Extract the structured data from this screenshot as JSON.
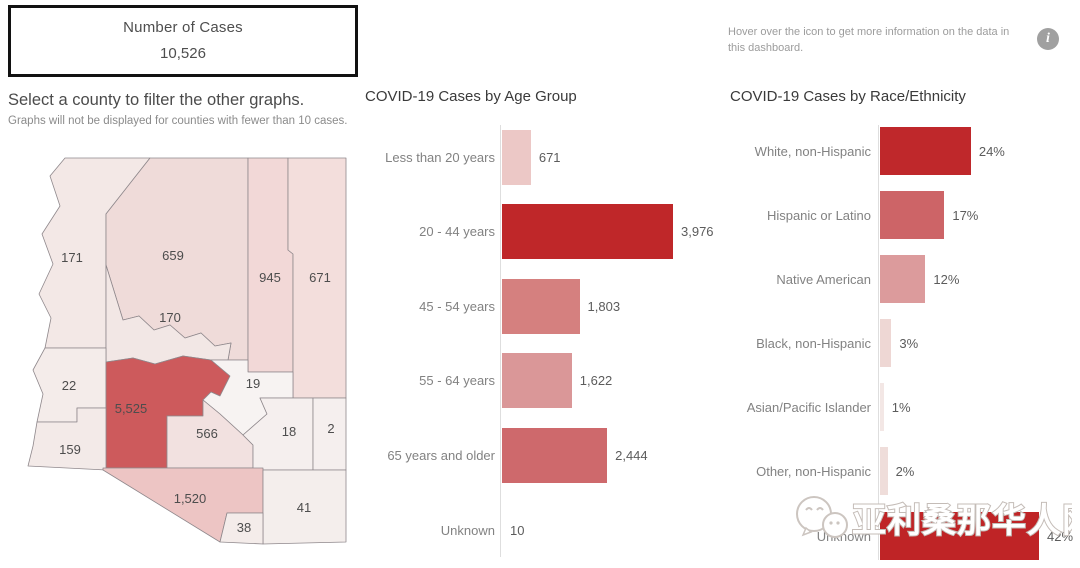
{
  "header": {
    "cases_box": {
      "title": "Number of Cases",
      "value": "10,526"
    },
    "info_note": "Hover over the icon to get more information on the data in this dashboard.",
    "info_icon_glyph": "i"
  },
  "map_section": {
    "instruction": "Select a county to filter the other graphs.",
    "subtitle": "Graphs will not be displayed for counties with fewer than 10 cases."
  },
  "watermark": {
    "text": "亚利桑那华人网",
    "icon": "wechat-logo"
  },
  "colors": {
    "dark_red": "#bf2729",
    "map_max_red": "#cd5a5c",
    "axis_gray": "#dedede",
    "label_gray": "#828282"
  },
  "chart_data": [
    {
      "type": "bar",
      "orientation": "horizontal",
      "title": "COVID-19 Cases by Age Group",
      "categories": [
        "Less than 20 years",
        "20 -  44 years",
        "45 - 54 years",
        "55 - 64 years",
        "65 years and older",
        "Unknown"
      ],
      "values": [
        671,
        3976,
        1803,
        1622,
        2444,
        10
      ],
      "value_labels": [
        "671",
        "3,976",
        "1,803",
        "1,622",
        "2,444",
        "10"
      ],
      "bar_colors": [
        "#ecc8c6",
        "#bf2729",
        "#d5807f",
        "#da9798",
        "#ce696c",
        "#bf2729"
      ],
      "xmax": 3976,
      "grid": false,
      "value_label_position": "right"
    },
    {
      "type": "bar",
      "orientation": "horizontal",
      "title": "COVID-19 Cases by Race/Ethnicity",
      "categories": [
        "White, non-Hispanic",
        "Hispanic or Latino",
        "Native American",
        "Black, non-Hispanic",
        "Asian/Pacific Islander",
        "Other, non-Hispanic",
        "Unknown"
      ],
      "values": [
        24,
        17,
        12,
        3,
        1,
        2,
        42
      ],
      "value_labels": [
        "24%",
        "17%",
        "12%",
        "3%",
        "1%",
        "2%",
        "42%"
      ],
      "bar_colors": [
        "#bf282b",
        "#cd6467",
        "#dc9b9c",
        "#eed7d4",
        "#f3e7e5",
        "#efddda",
        "#bf2426"
      ],
      "xmax": 42,
      "unit": "%",
      "grid": false,
      "value_label_position": "right"
    },
    {
      "type": "choropleth",
      "title": "Arizona county map of case counts",
      "counties": {
        "mohave": {
          "label": "171",
          "value": 171,
          "fill": "#f3e8e6"
        },
        "coconino": {
          "label": "659",
          "value": 659,
          "fill": "#efdbd9"
        },
        "navajo": {
          "label": "945",
          "value": 945,
          "fill": "#f2d8d7"
        },
        "apache": {
          "label": "671",
          "value": 671,
          "fill": "#f3dedc"
        },
        "yavapai": {
          "label": "170",
          "value": 170,
          "fill": "#f2e7e5"
        },
        "la_paz": {
          "label": "22",
          "value": 22,
          "fill": "#f4ecea"
        },
        "maricopa": {
          "label": "5,525",
          "value": 5525,
          "fill": "#cd5a5c"
        },
        "gila": {
          "label": "19",
          "value": 19,
          "fill": "#f7f3f2"
        },
        "yuma": {
          "label": "159",
          "value": 159,
          "fill": "#f3eae8"
        },
        "pinal": {
          "label": "566",
          "value": 566,
          "fill": "#f2e1e0"
        },
        "graham": {
          "label": "18",
          "value": 18,
          "fill": "#f5efee"
        },
        "greenlee": {
          "label": "2",
          "value": 2,
          "fill": "#f5efee"
        },
        "pima": {
          "label": "1,520",
          "value": 1520,
          "fill": "#edc5c4"
        },
        "cochise": {
          "label": "41",
          "value": 41,
          "fill": "#f4eeec"
        },
        "santa_cruz": {
          "label": "38",
          "value": 38,
          "fill": "#f4ecea"
        }
      }
    }
  ]
}
